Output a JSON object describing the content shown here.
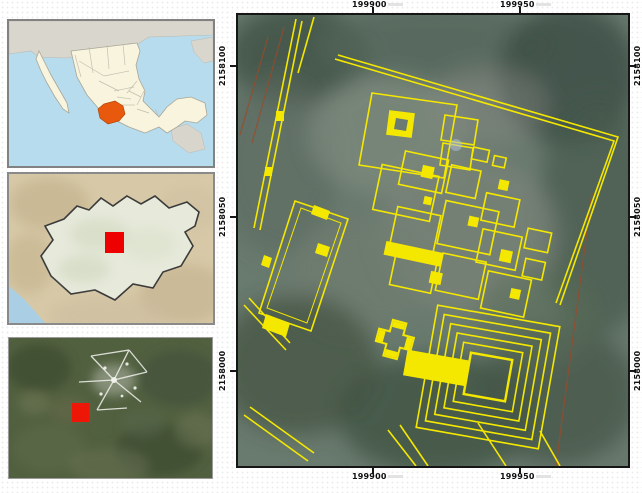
{
  "figure": {
    "description": "Archaeological site location figure: Mexico overview, Michoacan state map, regional satellite view, and site plan overlaid on satellite imagery"
  },
  "grid": {
    "top": [
      "199900",
      "199950"
    ],
    "bottom": [
      "199900",
      "199950"
    ],
    "left": [
      "2158100",
      "2158050",
      "2158000"
    ],
    "right": [
      "2158100",
      "2158050",
      "2158000"
    ]
  },
  "colors": {
    "site_outline_yellow": "#f5e800",
    "marker_red": "#ee1607",
    "mexico_state_highlight": "#e8590e",
    "sea_blue": "#b7dcee",
    "survey_line_red": "#9c4a2a"
  },
  "markers": {
    "state_inset_marker": "red-square",
    "satellite_inset_marker": "red-square",
    "mexico_inset_highlight": "highlighted-state"
  }
}
